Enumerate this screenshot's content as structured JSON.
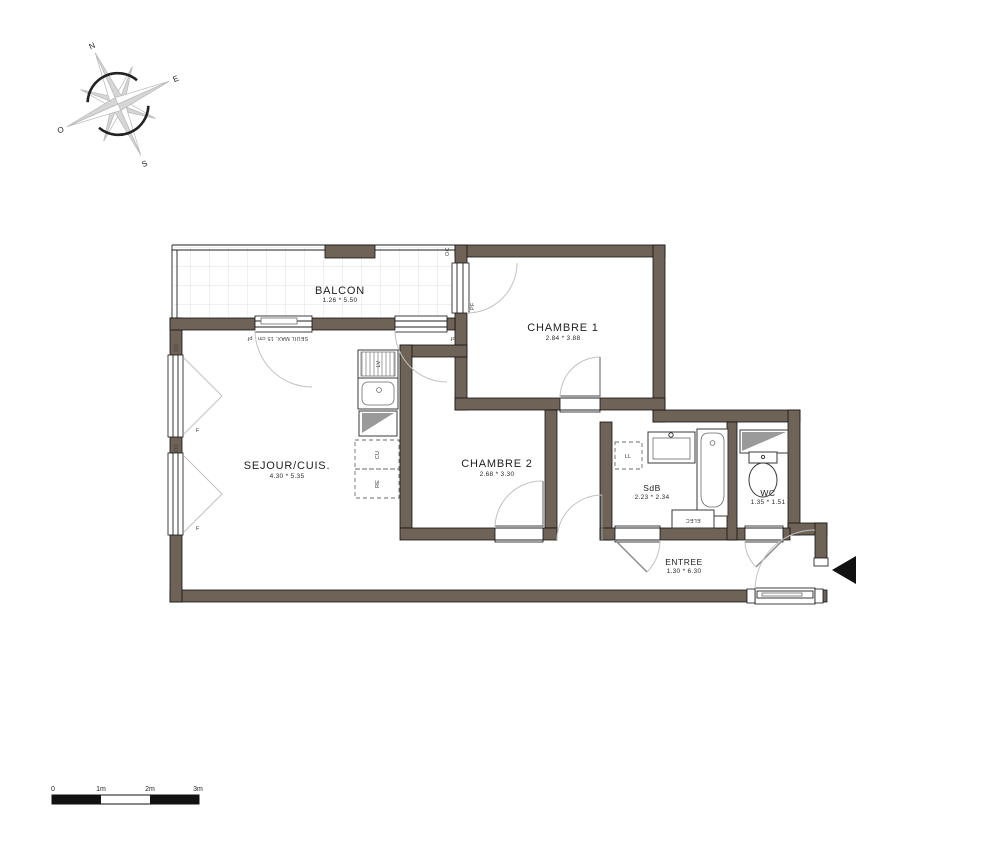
{
  "rooms": {
    "balcon": {
      "name": "BALCON",
      "dims": "1.26 * 5.50"
    },
    "chambre1": {
      "name": "CHAMBRE 1",
      "dims": "2.84 * 3.88"
    },
    "sejour": {
      "name": "SEJOUR/CUIS.",
      "dims": "4.30 * 5.35"
    },
    "chambre2": {
      "name": "CHAMBRE 2",
      "dims": "2.68 * 3.30"
    },
    "sdb": {
      "name": "SdB",
      "dims": "2.23 * 2.34"
    },
    "wc": {
      "name": "WC",
      "dims": "1.35 * 1.51"
    },
    "entree": {
      "name": "ENTREE",
      "dims": "1.30 * 6.30"
    }
  },
  "labels": {
    "lv": "LV",
    "cu": "CU",
    "re": "RE",
    "ll": "LL",
    "elec": "ELEC",
    "pf": "PF",
    "pf_lower": "pf",
    "f": "F",
    "oc": "OC",
    "seuil_note": "SEUIL MAX. 15 cm"
  },
  "compass": {
    "points": [
      "N",
      "E",
      "S",
      "O"
    ]
  },
  "scale_bar": {
    "ticks": [
      "0",
      "1m",
      "2m",
      "3m"
    ]
  },
  "colors": {
    "wall": "#6e6356",
    "tile_line": "#e0e0e0",
    "gray_fill": "#9a9a9a"
  }
}
